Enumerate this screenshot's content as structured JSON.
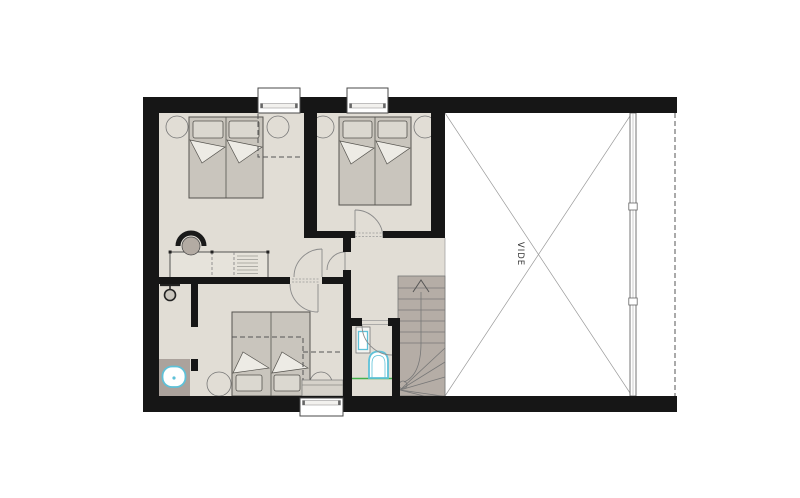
{
  "labels": {
    "void": "VIDE"
  },
  "colors": {
    "background": "#ffffff",
    "wall": "#161616",
    "floor": "#e1ddd5",
    "furniture": "#c9c5bd",
    "pillow": "#dbd8d0",
    "fold": "#edebe5",
    "stairs": "#b5ada6",
    "counter": "#aba29c",
    "accent": "#5ec1d8",
    "green": "#43b04a",
    "line": "#777777",
    "dash": "#555555",
    "text": "#333333"
  }
}
